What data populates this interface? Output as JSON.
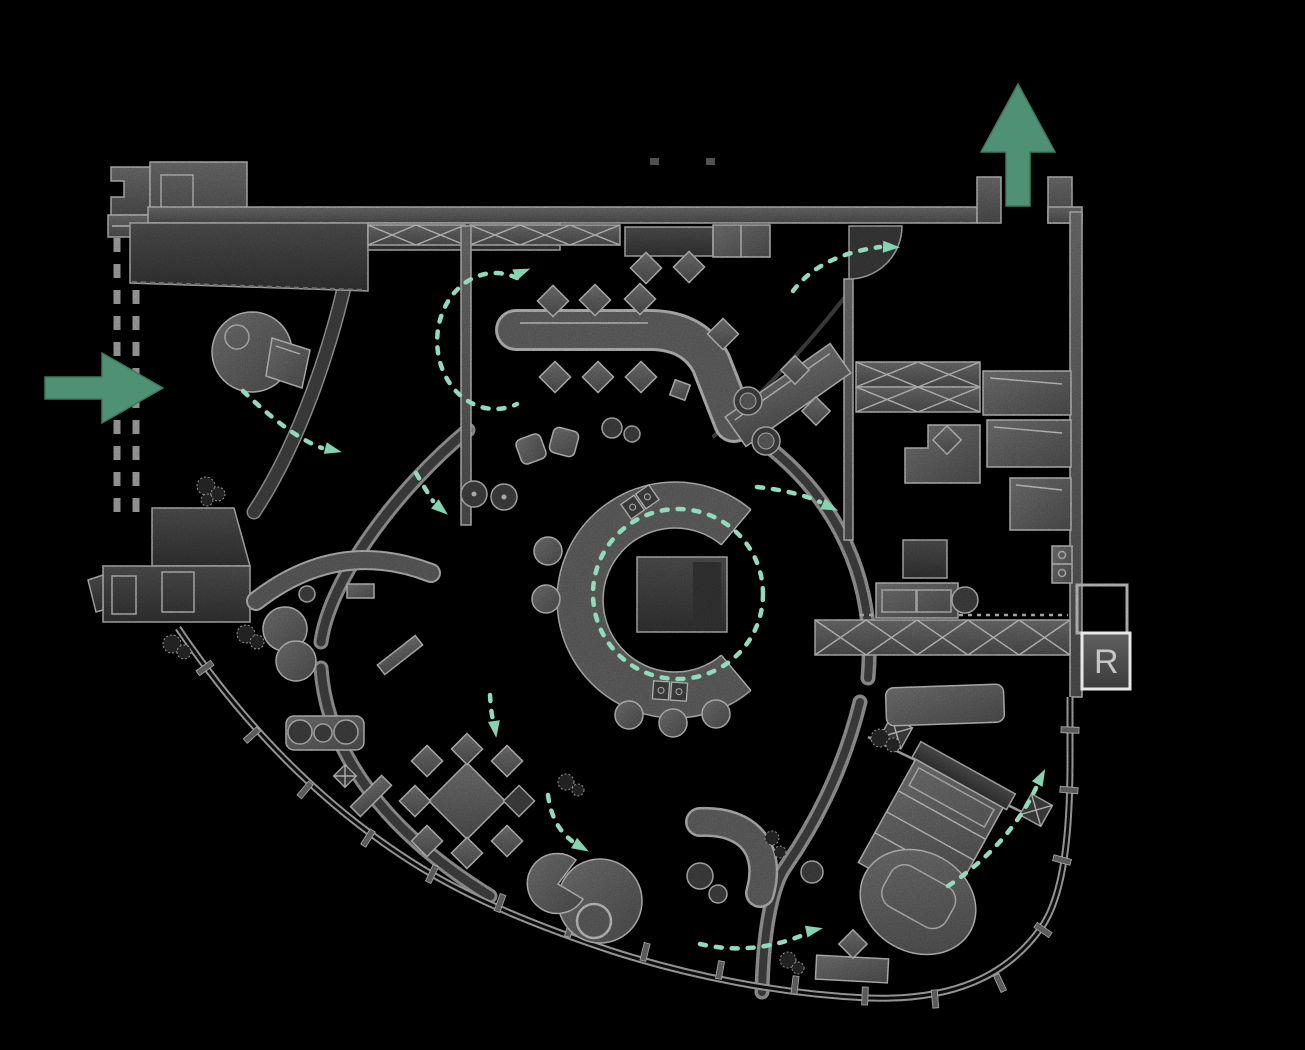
{
  "meta": {
    "type": "interior floor plan concept diagram",
    "background": "#000000"
  },
  "palette": {
    "wall_gray": "#6e6e6e",
    "wall_dark": "#4a4a4a",
    "outline_white": "#dcdcdc",
    "furniture_gray": "#787878",
    "entry_arrow_green": "#4e9174",
    "circulation_mint": "#8fdcbc",
    "marker_text_gray": "#c7c7c7"
  },
  "plan": {
    "room_marker_label": "R",
    "entry_arrow": {
      "icon": "arrow-right-icon",
      "direction": "right"
    },
    "exit_arrow": {
      "icon": "arrow-up-icon",
      "direction": "up"
    },
    "circulation": {
      "style": "dashed",
      "color": "#8fdcbc"
    },
    "elements": [
      "entry-porch",
      "entrance-corridor-dashed",
      "reception-round-desk",
      "canopy-wall",
      "x-braced-shelving-top",
      "service-counter",
      "bent-worktable-with-chairs",
      "angled-meeting-table",
      "door-swing",
      "private-room-shelving",
      "wall-desks",
      "l-shaped-desk",
      "kitchen-counter",
      "appliance-block",
      "stacked-units",
      "central-bar-ring",
      "bar-square-table",
      "bar-stools",
      "bar-sinks",
      "lounge-armchairs",
      "coffee-tables",
      "curved-sofa",
      "ottomans",
      "pouf-row-on-mat",
      "diamond-dining-set",
      "pacman-lounge",
      "banana-sofa",
      "bed-suite",
      "x-nightstands",
      "foot-couch",
      "console-bench",
      "balcony-railing",
      "planters",
      "room-marker-box",
      "circulation-dashed-paths"
    ]
  }
}
